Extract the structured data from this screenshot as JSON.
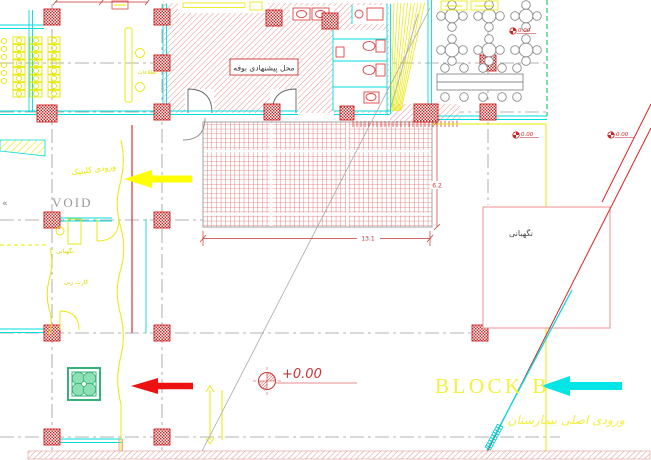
{
  "drawing": {
    "type": "architectural-site-plan",
    "labels": {
      "buffet_proposed": "محل پیشنهادی بوفه",
      "information": "اطلاعات",
      "clinic_entrance": "ورودی کلینیک",
      "void": "VOID",
      "void_marker": "«",
      "guard_station": "نگهبانی",
      "card_punch": "کارت زنی",
      "guard_post": "نگهبانی",
      "block_b": "BLOCK B",
      "hospital_main_entrance": "ورودی اصلی بیمارستان"
    },
    "levels": {
      "main": "+0.00",
      "spot_terrace": "0.00",
      "spot_road_left": "0.00",
      "spot_road_right": "0.00"
    },
    "dimensions": {
      "courtyard_width": "13.1",
      "courtyard_height": "6.2"
    },
    "colors": {
      "wall_cyan": "#00dddd",
      "furniture_yellow": "#e8e800",
      "hatch_red": "#e08080",
      "dimension_red": "#cc2222",
      "arrow_red": "#ee1111",
      "arrow_yellow": "#ffff00",
      "arrow_cyan": "#00e5e5",
      "planter_green": "#33b377",
      "centerline_gray": "#9a9a9a",
      "road_green": "#00bb44"
    }
  }
}
